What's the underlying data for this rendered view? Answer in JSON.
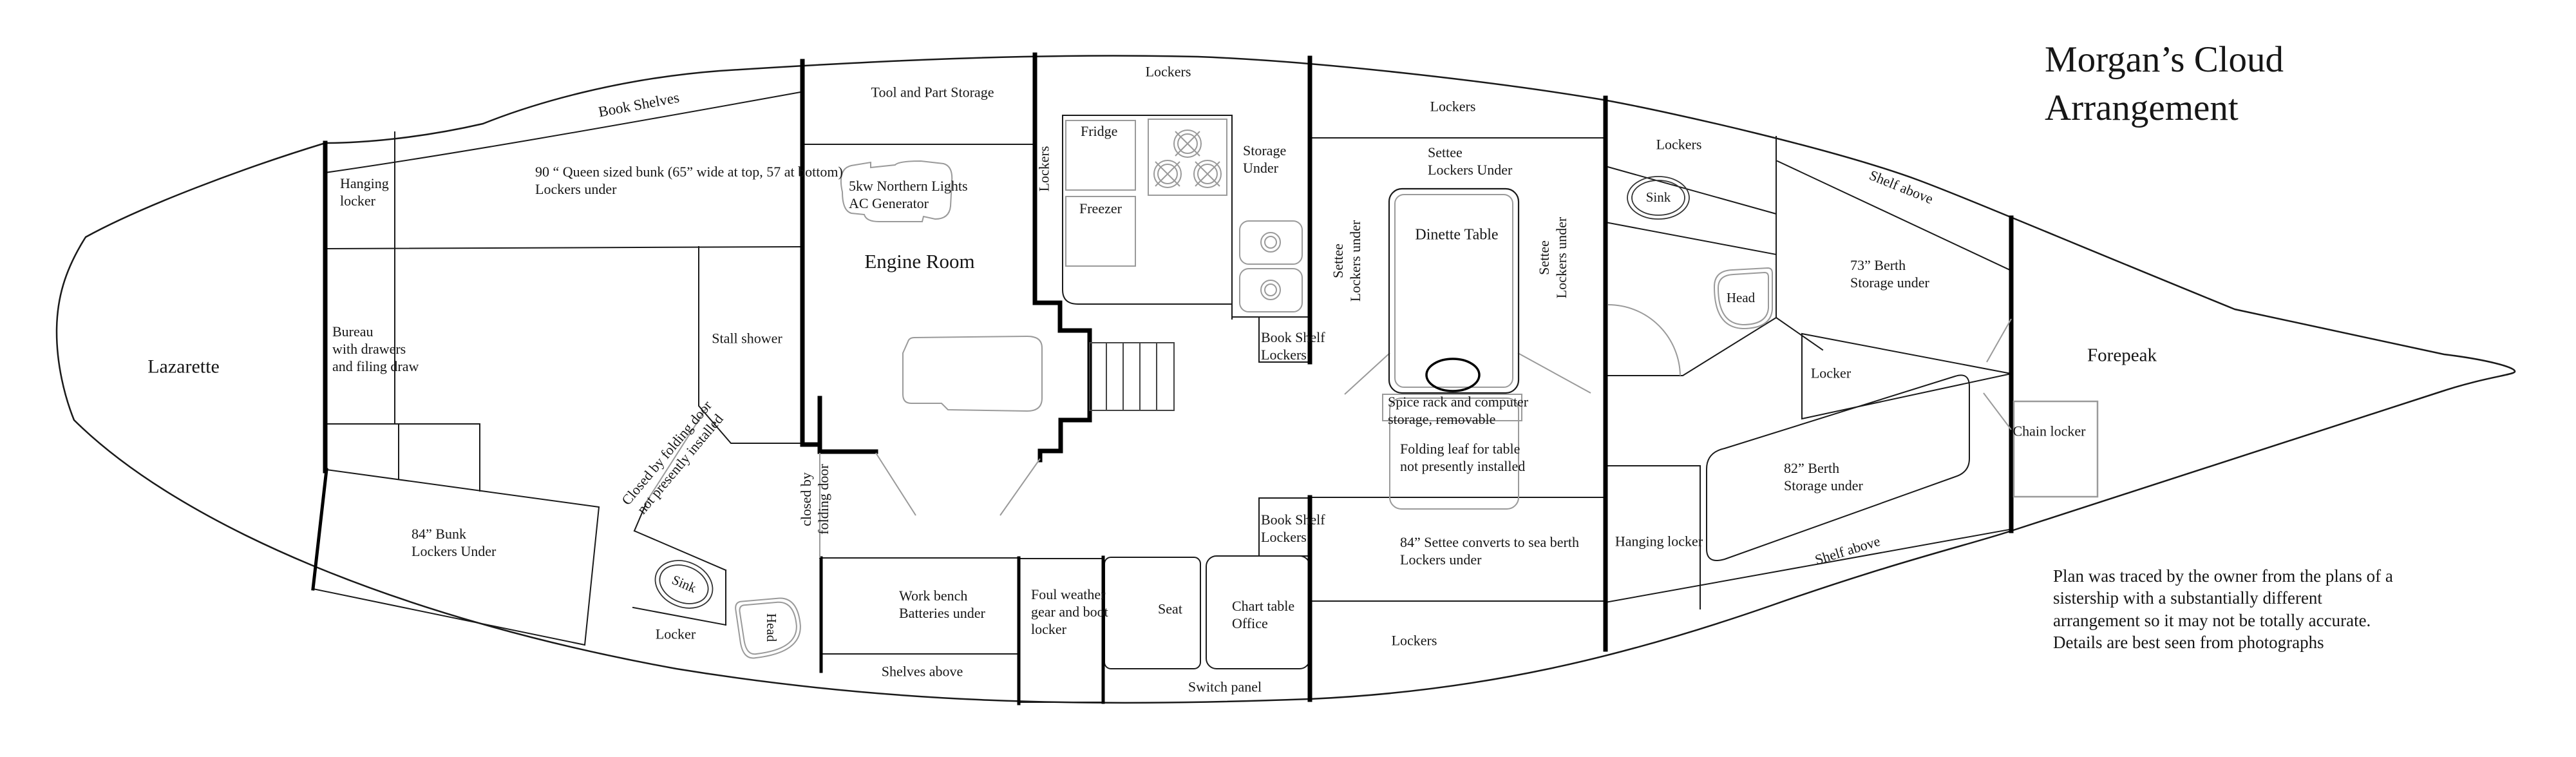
{
  "title": "Morgan’s Cloud\nArrangement",
  "note": "Plan was traced by the owner from the plans of a\nsistership with a substantially different\narrangement so it may not be totally accurate.\nDetails are best seen from photographs",
  "labels": {
    "lazarette": "Lazarette",
    "hanging_locker_aft": "Hanging\nlocker",
    "bureau": "Bureau\nwith drawers\nand filing draw",
    "book_shelves": "Book Shelves",
    "queen_bunk": "90 “ Queen sized bunk (65” wide at top, 57 at bottom)\nLockers under",
    "tool_part_storage": "Tool and Part Storage",
    "generator": "5kw Northern Lights\nAC Generator",
    "engine_room": "Engine Room",
    "lockers_engine": "Lockers",
    "fridge": "Fridge",
    "freezer": "Freezer",
    "lockers_galley": "Lockers",
    "storage_under": "Storage\nUnder",
    "book_shelf_lockers_upper": "Book Shelf\nLockers",
    "lockers_settee_top": "Lockers",
    "settee_lockers_under_top": "Settee\nLockers Under",
    "dinette_table": "Dinette Table",
    "settee_rot_left": "Settee\nLockers under",
    "settee_rot_right": "Settee\nLockers under",
    "spice_rack": "Spice rack and computer\nstorage, removable",
    "folding_leaf": "Folding leaf for table\nnot presently installed",
    "settee_84": "84” Settee converts to sea berth\nLockers under",
    "lockers_port_bottom": "Lockers",
    "closed_folding_door_vert": "closed by\nfolding door",
    "closed_folding_door_diag": "Closed by folding door\nnot presently installed",
    "stall_shower": "Stall shower",
    "bunk_84": "84” Bunk\nLockers Under",
    "locker_aft": "Locker",
    "sink_aft": "Sink",
    "head_aft": "Head",
    "work_bench": "Work bench\nBatteries under",
    "shelves_above": "Shelves above",
    "foul_weather": "Foul weather\ngear and boot\nlocker",
    "seat": "Seat",
    "chart_table": "Chart table\nOffice",
    "switch_panel": "Switch panel",
    "book_shelf_lockers_lower": "Book Shelf\nLockers",
    "lockers_fwd": "Lockers",
    "sink_fwd": "Sink",
    "head_fwd": "Head",
    "shelf_above_fwd_top": "Shelf above",
    "berth_73": "73” Berth\nStorage under",
    "locker_fwd_triangle": "Locker",
    "hanging_locker_fwd": "Hanging locker",
    "berth_82": "82” Berth\nStorage under",
    "shelf_above_fwd_bottom": "Shelf above",
    "chain_locker": "Chain locker",
    "forepeak": "Forepeak"
  }
}
